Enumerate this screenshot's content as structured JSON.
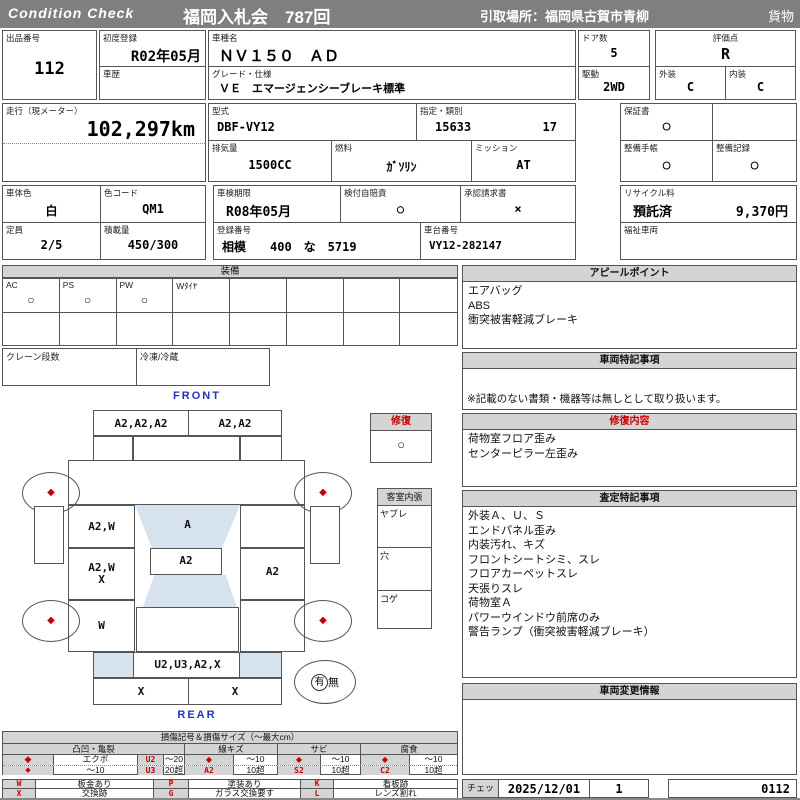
{
  "header": {
    "brand": "Condition  Check",
    "auction": "福岡入札会　787回",
    "pickup": "引取場所：福岡県古賀市青柳",
    "category": "貨物"
  },
  "info": {
    "lot": {
      "label": "出品番号",
      "value": "112"
    },
    "first_reg": {
      "label": "初度登録",
      "value": "R02年05月"
    },
    "history": {
      "label": "車歴"
    },
    "model": {
      "label": "車種名",
      "value": "ＮＶ１５０　ＡＤ"
    },
    "grade": {
      "label": "グレード・仕様",
      "value": "ＶＥ　エマージェンシーブレーキ標準"
    },
    "doors": {
      "label": "ドア数",
      "value": "5"
    },
    "score": {
      "label": "評価点",
      "value": "R"
    },
    "drive": {
      "label": "駆動",
      "value": "2WD"
    },
    "exterior": {
      "label": "外装",
      "value": "C"
    },
    "interior": {
      "label": "内装",
      "value": "C"
    },
    "mileage": {
      "label": "走行（現メーター）",
      "value": "102,297km"
    },
    "type": {
      "label": "型式",
      "value": "DBF-VY12"
    },
    "class": {
      "label": "指定・類別",
      "value1": "15633",
      "value2": "17"
    },
    "displacement": {
      "label": "排気量",
      "value": "1500CC"
    },
    "fuel": {
      "label": "燃料",
      "value": "ｶﾞｿﾘﾝ"
    },
    "mission": {
      "label": "ミッション",
      "value": "AT"
    },
    "warranty": {
      "label": "保証書",
      "value": "○"
    },
    "book": {
      "label": "整備手帳",
      "value": "○"
    },
    "record": {
      "label": "整備記録",
      "value": "○"
    },
    "body_color": {
      "label": "車体色",
      "value": "白"
    },
    "color_code": {
      "label": "色コード",
      "value": "QM1"
    },
    "capacity": {
      "label": "定員",
      "value": "2/5"
    },
    "load": {
      "label": "積載量",
      "value": "450/300"
    },
    "inspection": {
      "label": "車検期限",
      "value": "R08年05月"
    },
    "insurance": {
      "label": "検付自賠責",
      "value": "○"
    },
    "approval": {
      "label": "承認請求書",
      "value": "×"
    },
    "recycle": {
      "label": "リサイクル料",
      "status": "預託済",
      "fee": "9,370円"
    },
    "reg_no": {
      "label": "登録番号",
      "value": "相模　　400　な　5719"
    },
    "chassis": {
      "label": "車台番号",
      "value": "VY12-282147"
    },
    "welfare": {
      "label": "福祉車両"
    }
  },
  "equipment": {
    "title": "装備",
    "cols": [
      {
        "label": "AC",
        "mark": "○"
      },
      {
        "label": "PS",
        "mark": "○"
      },
      {
        "label": "PW",
        "mark": "○"
      },
      {
        "label": "Wﾀｲﾔ",
        "mark": ""
      },
      {
        "label": "",
        "mark": ""
      },
      {
        "label": "",
        "mark": ""
      },
      {
        "label": "",
        "mark": ""
      },
      {
        "label": "",
        "mark": ""
      }
    ],
    "crane_label": "クレーン段数",
    "reefer_label": "冷凍/冷蔵"
  },
  "diagram": {
    "front_label": "FRONT",
    "rear_label": "REAR",
    "front_bumper": {
      "left": "A2,A2,A2",
      "right": "A2,A2"
    },
    "left_front": "A2,W",
    "windshield": "A",
    "roof": "A2",
    "left_mid_1": "A2,W",
    "left_mid_2": "X",
    "right_mid": "A2",
    "left_rear": "W",
    "rear_bumper": "U2,U3,A2,X",
    "rear_strip_left": "X",
    "rear_strip_right": "X",
    "repair_box": {
      "title": "修復",
      "mark": "○"
    },
    "cabin_box": {
      "title": "客室内張",
      "row1": "ヤブレ",
      "row2": "穴",
      "row3": "コゲ"
    },
    "spare": {
      "present": "有",
      "absent": "無"
    }
  },
  "sections": {
    "appeal": {
      "title": "アピールポイント",
      "lines": [
        "エアバッグ",
        "ABS",
        "衝突被害軽減ブレーキ"
      ]
    },
    "vehicle_notes": {
      "title": "車両特記事項",
      "note": "※記載のない書類・機器等は無しとして取り扱います。"
    },
    "repair": {
      "title": "修復内容",
      "lines": [
        "荷物室フロア歪み",
        "センターピラー左歪み"
      ]
    },
    "assessment": {
      "title": "査定特記事項",
      "lines": [
        "外装Ａ、Ｕ、Ｓ",
        "エンドパネル歪み",
        "内装汚れ、キズ",
        "フロントシートシミ、スレ",
        "フロアカーペットスレ",
        "天張りスレ",
        "荷物室Ａ",
        "パワーウインドウ前席のみ",
        "警告ランプ（衝突被害軽減ブレーキ）"
      ]
    },
    "change_info": {
      "title": "車両変更情報"
    }
  },
  "legend": {
    "title": "損傷記号＆損傷サイズ（～最大cm）",
    "dent": {
      "group": "凸凹・亀裂",
      "r1": [
        "◆",
        "エクボ",
        "U2",
        "～20"
      ],
      "r2": [
        "◆",
        "～10",
        "U3",
        "20超"
      ]
    },
    "scratch": {
      "group": "線キズ",
      "r1": [
        "◆",
        "～10"
      ],
      "r2": [
        "A2",
        "10超"
      ]
    },
    "rust": {
      "group": "サビ",
      "r1": [
        "◆",
        "～10"
      ],
      "r2": [
        "S2",
        "10超"
      ]
    },
    "corrosion": {
      "group": "腐食",
      "r1": [
        "◆",
        "～10"
      ],
      "r2": [
        "C2",
        "10超"
      ]
    },
    "codes": {
      "w": {
        "code": "W",
        "label": "板金あり"
      },
      "p": {
        "code": "P",
        "label": "塗装あり"
      },
      "k": {
        "code": "K",
        "label": "看板跡"
      },
      "x": {
        "code": "X",
        "label": "交換跡"
      },
      "g": {
        "code": "G",
        "label": "ガラス交換要す"
      },
      "l": {
        "code": "L",
        "label": "レンズ割れ"
      }
    }
  },
  "footer": {
    "check_label": "チェック",
    "date": "2025/12/01",
    "count": "1",
    "code": "0112"
  },
  "icons": {
    "diamond": "◆",
    "circle": "○",
    "cross": "×"
  },
  "colors": {
    "header_gray": "#7f7f7f",
    "bar_gray": "#d4d4d4",
    "accent_red": "#cc0000",
    "glass_blue": "#d7e2ef",
    "cargo_gray": "#b3b3b3",
    "front_rear_blue": "#2233bb"
  }
}
